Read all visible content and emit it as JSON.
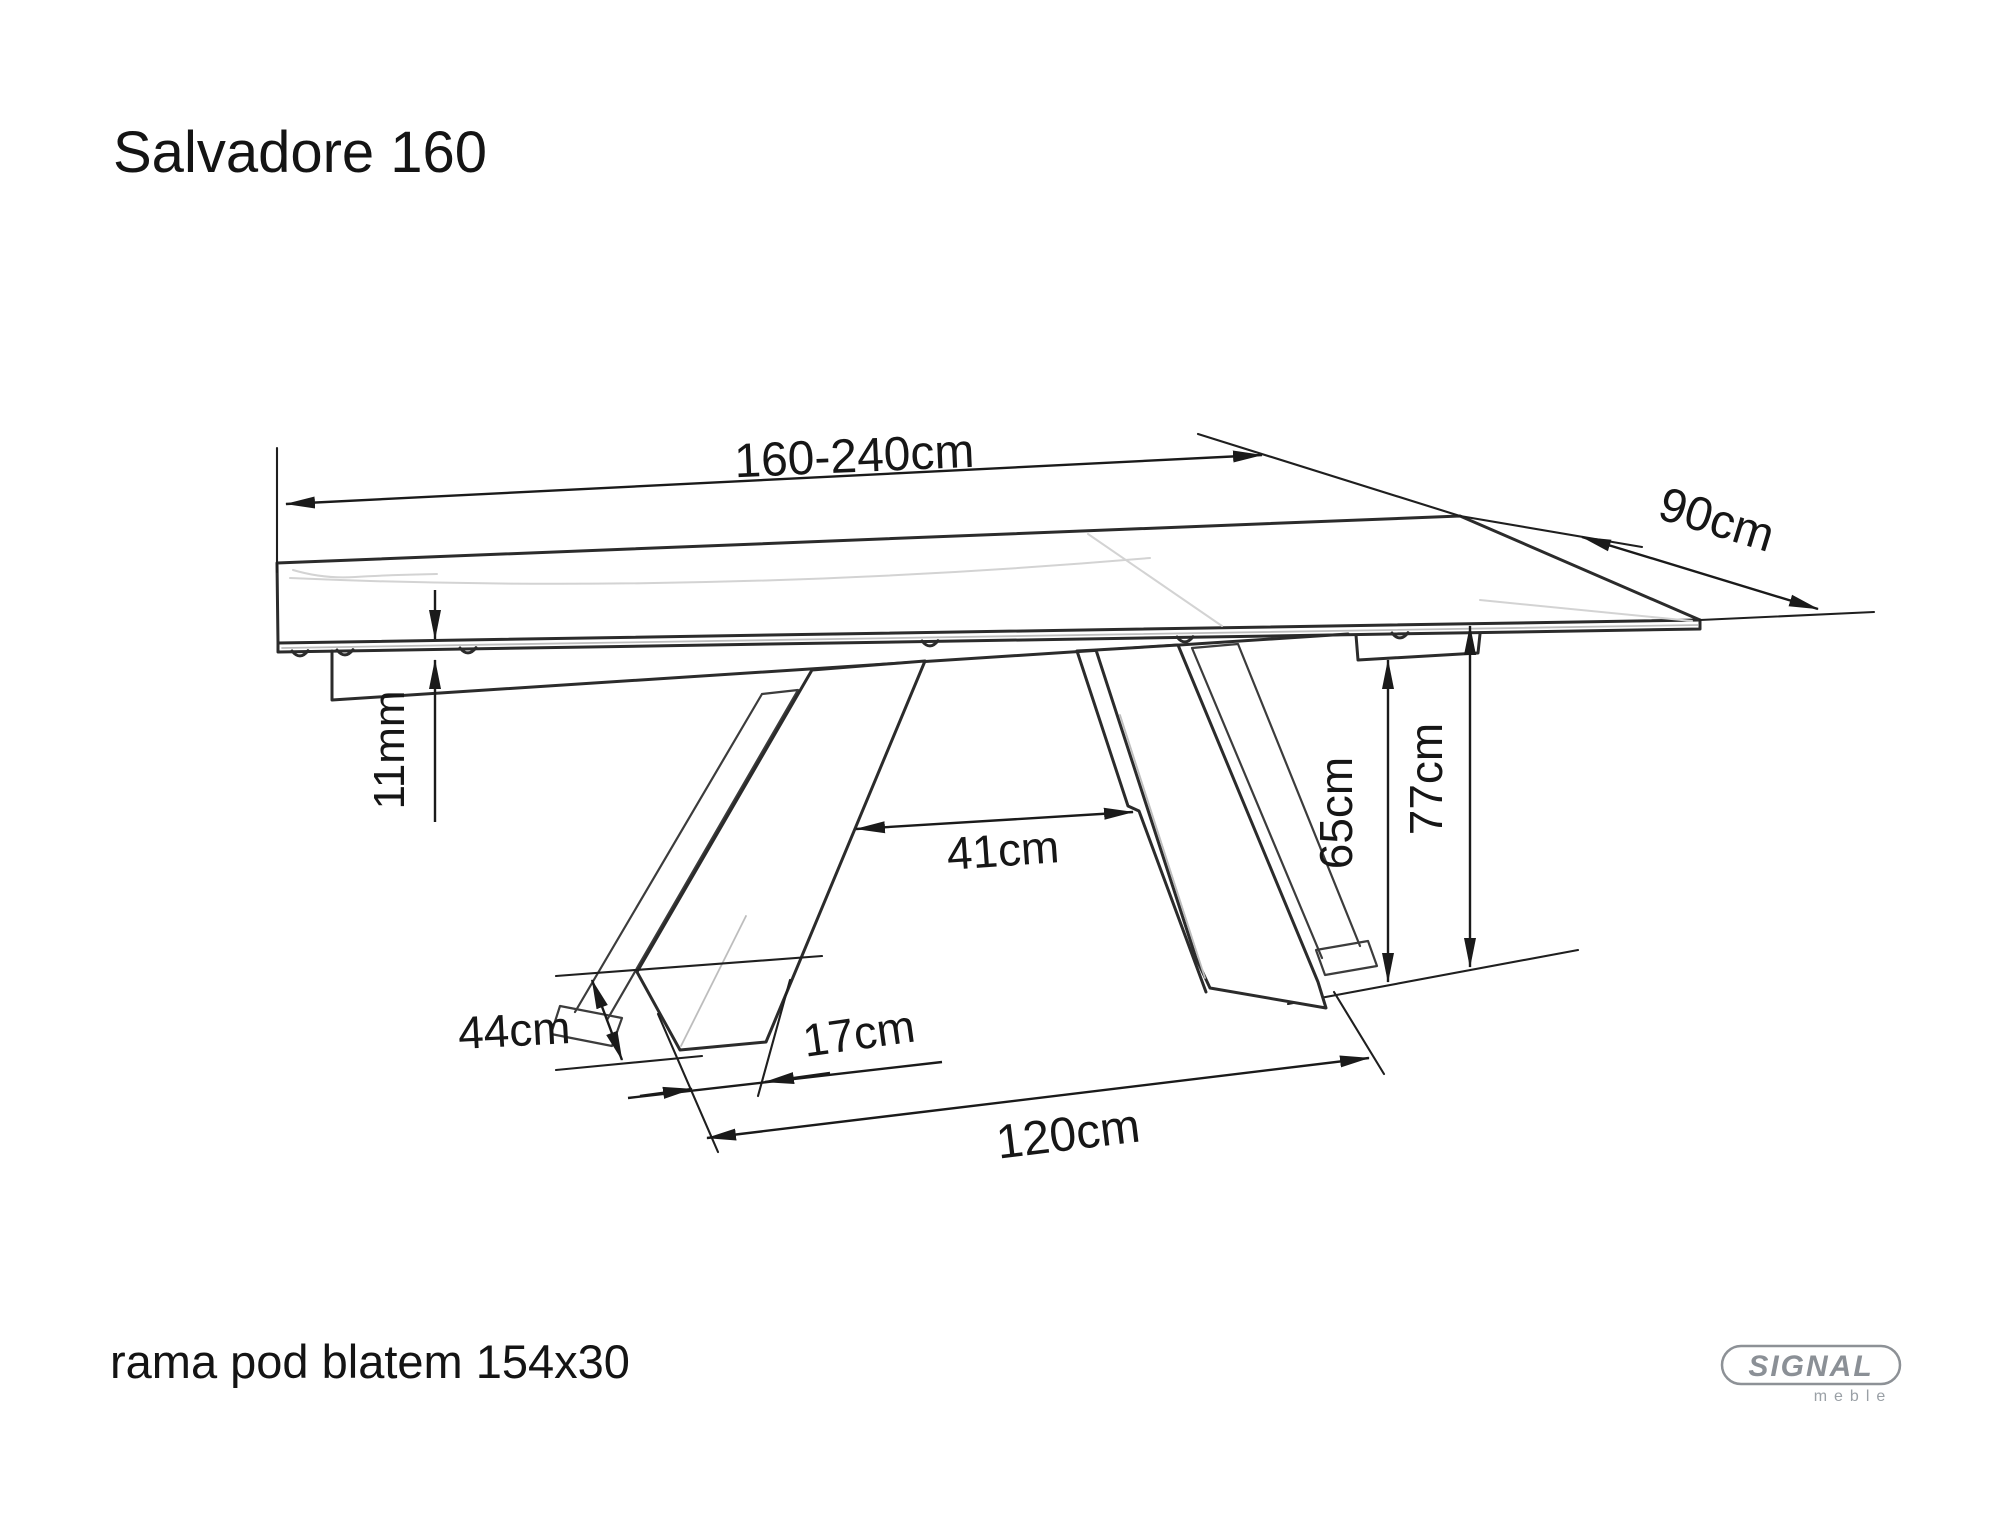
{
  "title": "Salvadore 160",
  "note": "rama pod blatem 154x30",
  "logo": {
    "brand": "SIGNAL",
    "sub": "meble"
  },
  "dimensions": {
    "length": "160-240cm",
    "depth": "90cm",
    "top_thickness": "11mm",
    "leg_gap": "41cm",
    "underframe_clearance": "65cm",
    "height": "77cm",
    "foot_length": "44cm",
    "foot_width": "17cm",
    "base_span": "120cm"
  },
  "colors": {
    "line": "#2b2b2b",
    "text": "#161616",
    "logo_gray": "#8b9096",
    "background": "#ffffff"
  }
}
